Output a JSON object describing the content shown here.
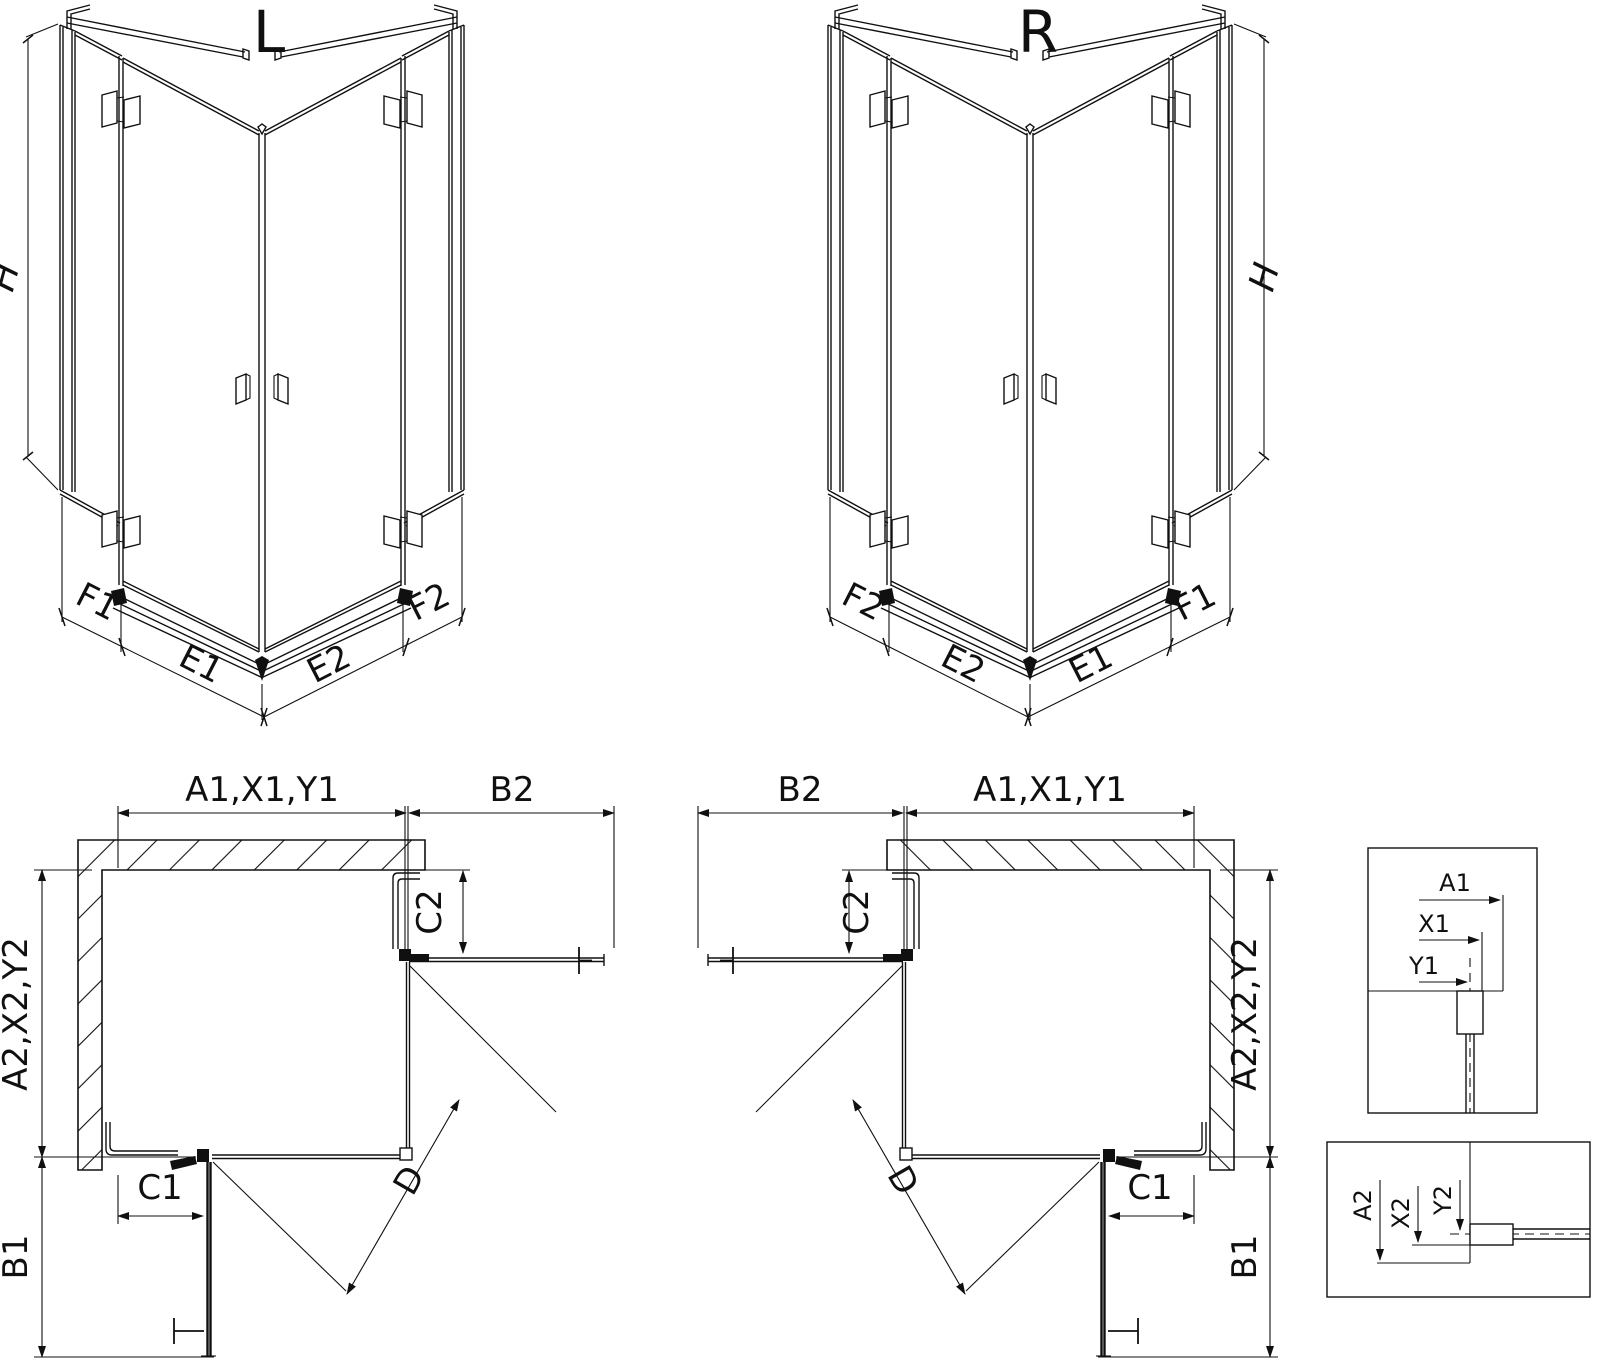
{
  "drawing": {
    "unit_l": {
      "title": "L",
      "dim_h": "H",
      "dim_f1": "F1",
      "dim_e1": "E1",
      "dim_e2": "E2",
      "dim_f2": "F2"
    },
    "unit_r": {
      "title": "R",
      "dim_h": "H",
      "dim_f1": "F1",
      "dim_e1": "E1",
      "dim_e2": "E2",
      "dim_f2": "F2"
    },
    "plan_l": {
      "dim_width": "A1,X1,Y1",
      "dim_door_top": "B2",
      "dim_c2": "C2",
      "dim_depth": "A2,X2,Y2",
      "dim_c1": "C1",
      "dim_b1": "B1",
      "dim_diag": "D"
    },
    "plan_r": {
      "dim_width": "A1,X1,Y1",
      "dim_door_top": "B2",
      "dim_c2": "C2",
      "dim_depth": "A2,X2,Y2",
      "dim_c1": "C1",
      "dim_b1": "B1",
      "dim_diag": "D"
    },
    "detail_top": {
      "dim_a1": "A1",
      "dim_x1": "X1",
      "dim_y1": "Y1"
    },
    "detail_bottom": {
      "dim_a2": "A2",
      "dim_x2": "X2",
      "dim_y2": "Y2"
    },
    "colors": {
      "ink": "#101010",
      "background": "#ffffff"
    }
  }
}
